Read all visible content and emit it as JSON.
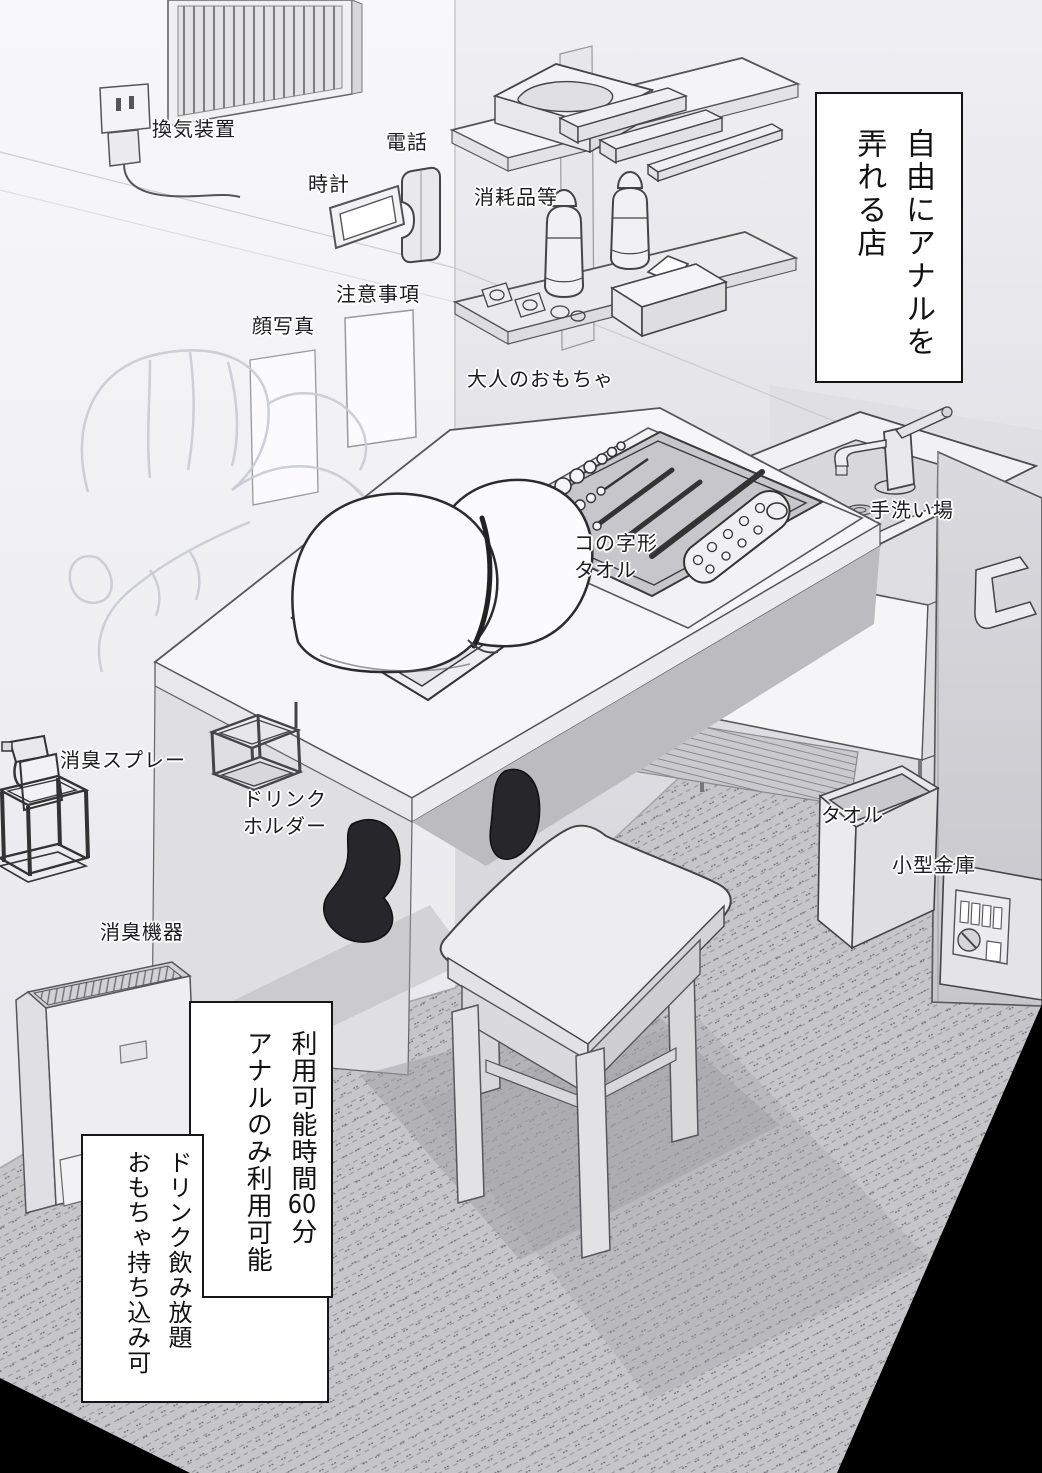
{
  "title_box": {
    "col1": "自由にアナルを",
    "col2": "弄れる店"
  },
  "labels": {
    "ventilation": "換気装置",
    "clock": "時計",
    "phone": "電話",
    "notes": "注意事項",
    "face_photo": "顔写真",
    "consumables": "消耗品等",
    "adult_toys": "大人のおもちゃ",
    "u_towel_line1": "コの字形",
    "u_towel_line2": "タオル",
    "hand_wash": "手洗い場",
    "deodorant_spray": "消臭スプレー",
    "drink_holder_line1": "ドリンク",
    "drink_holder_line2": "ホルダー",
    "towel": "タオル",
    "small_safe": "小型金庫",
    "deodorizer": "消臭機器"
  },
  "info_box_hours": {
    "col1_pre": "利用可能時間",
    "col1_num": "60",
    "col1_post": "分",
    "col2": "アナルのみ利用可能"
  },
  "info_box_drinks": {
    "col1": "ドリンク飲み放題",
    "col2": "おもちゃ持ち込み可"
  },
  "colors": {
    "ink": "#1a1a1a",
    "paper": "#ffffff",
    "wall_light": "#f5f5f7",
    "floor_carpet": "#c6c6c9",
    "corner_shadow": "#000000"
  }
}
